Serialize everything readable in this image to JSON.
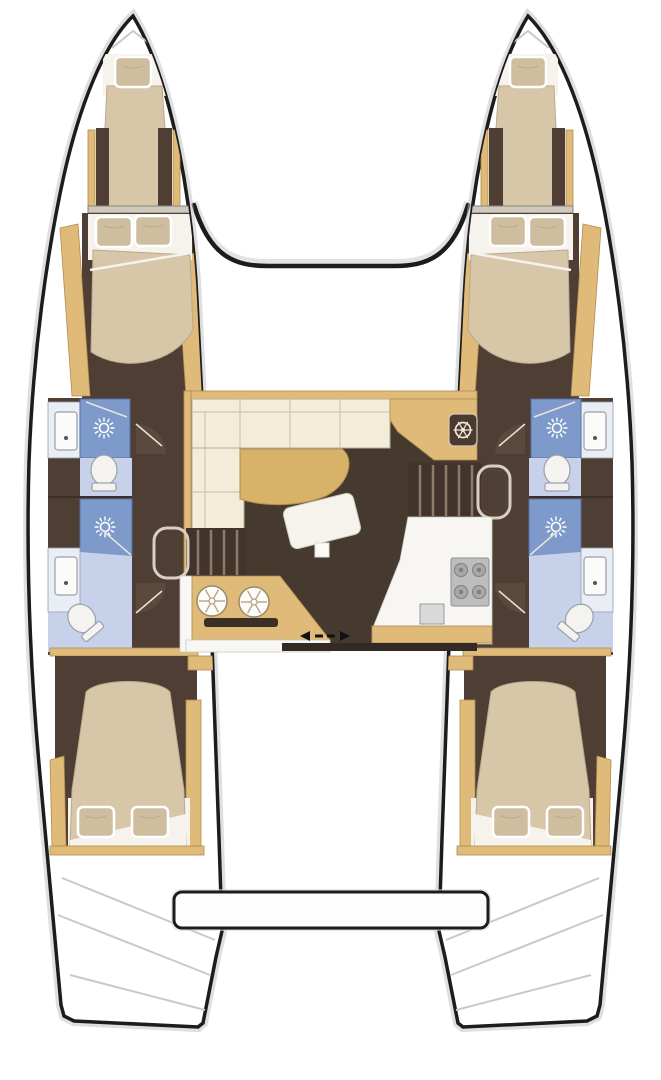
{
  "meta": {
    "type": "boat-floor-plan",
    "subject": "Catamaran sailing yacht interior layout, top-down deck plan",
    "visible_text": "none",
    "layout_summary": "Twin-hull catamaran: each hull has a bow berth, a forward double cabin, two bathrooms with shower and toilet amidships, and an aft double cabin. Central bridgedeck saloon with L-shaped sofa, curved table, navigation station with helm wheel, galley with twin round sinks and 4-burner stove, two companionway stairways, sliding aft door and stern swim platform."
  },
  "counts": {
    "double_cabins": 4,
    "bow_berths": 2,
    "bathrooms": 4,
    "showers": 4,
    "toilets": 4,
    "washbasins": 4,
    "stove_burners": 4,
    "galley_sinks": 2,
    "companionways": 2
  },
  "rooms": {
    "port_hull": "Port hull",
    "starboard_hull": "Starboard hull",
    "bow_berth": "Bow berth with single pillow",
    "forward_cabin": "Forward double cabin with two pillows",
    "forward_bathroom": "Forward bathroom: shower stall, toilet, washbasin",
    "aft_bathroom": "Aft bathroom: shower stall, toilet, washbasin",
    "aft_cabin": "Aft double cabin with two pillows",
    "saloon": "Main saloon",
    "sofa": "L-shaped cream sofa",
    "table": "Curved saloon table",
    "nav_station": "Navigation station with helm wheel",
    "ottoman": "Saloon ottoman / coffee seat",
    "mast_post": "Mast post / table leg",
    "port_companionway": "Port companionway steps down to hull",
    "starboard_companionway": "Starboard companionway steps down to hull",
    "galley_unit": "Galley unit with twin round sinks and oven slot",
    "galley_counter": "Galley counter with 4-burner stove",
    "sliding_door": "Sliding door to cockpit (direction arrows)",
    "foredeck_beam": "Forward crossbeam between hulls",
    "swim_platform": "Aft platform between hulls",
    "stern_steps": "Transom steps"
  },
  "fixtures": {
    "shower_icon": "shower spray rosette",
    "toilet_icon": "marine toilet",
    "sink_icon": "washbasin with tap",
    "helm_icon": "ship's wheel",
    "burner_icon": "stove burner",
    "galley_sink_icon": "round sink with drain spokes"
  },
  "colors": {
    "outline": "#1c1c1c",
    "hull": "#ffffff",
    "shadow": "#bfbfbf",
    "wood": "#dfba79",
    "wood_dark": "#b08c4f",
    "table": "#d9b26a",
    "floor": "#4e3e33",
    "floor_saloon": "#463a2f",
    "bed": "#d8c6a9",
    "pillow": "#cfbd9f",
    "sheet": "#f6f3ec",
    "sofa": "#f2ecd9",
    "shower": "#7e9acb",
    "bath_floor": "#c7d2ea",
    "bath_panel": "#e8edf6",
    "fixture": "#f6f5f2",
    "fixture_stroke": "#98a0ac",
    "stove": "#bdbdbd",
    "burner": "#a8a8a8",
    "stairs": "#42342b",
    "stair_line": "#8d7b69",
    "accent_dark": "#332a23"
  }
}
